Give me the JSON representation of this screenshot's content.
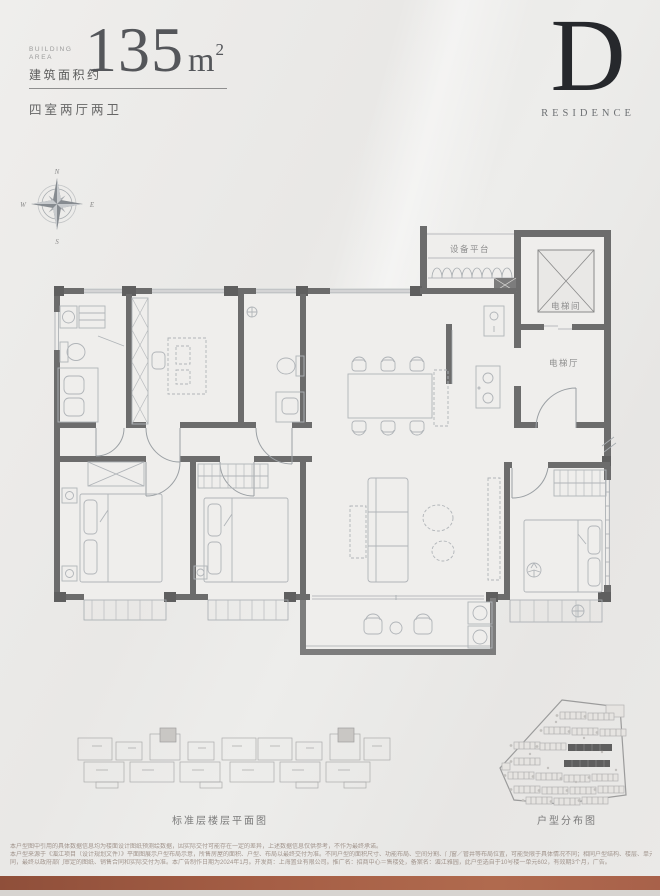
{
  "header": {
    "building_area_line1": "BUILDING",
    "building_area_line2": "AREA",
    "area_cn": "建筑面积约",
    "area_value": "135",
    "area_unit": "m",
    "area_sup": "2",
    "layout_spec": "四室两厅两卫"
  },
  "brand": {
    "letter": "D",
    "word": "RESIDENCE"
  },
  "compass": {
    "n": "N",
    "e": "E",
    "s": "S",
    "w": "W"
  },
  "plan_labels": {
    "equipment_platform": "设备平台",
    "elevator_room": "电梯间",
    "elevator_hall": "电梯厅"
  },
  "captions": {
    "standard_floor": "标准层楼层平面图",
    "distribution": "户型分布图"
  },
  "disclaimer": {
    "line1": "本户型图中引用的具体数据信息均为楼面设计图纸预测绘数据，因实际交付可能存在一定的差异，上述数据信息仅供参考，不作为最终承诺。",
    "line2": "本户型来源于《湄江项目（设计规划文件）》平面图展示户型布局示意，所售房屋的面积、户型、布局以最终交付为准。不同户型的面积尺寸、功能布局、空间分割、门窗／管井等布局位置，可能受限于具体情况不同；相同户型结构、楼层、单元等差别，局部结构、面积等也可能不",
    "line3": "同，最终以政府部门审定的图纸、销售合同和实际交付为准。本广告制作日期为2024年1月。开发商：上海置业有限公司。推广名：招商中心＝售楼处，备案名：湄江雅园，此户型选自于10号楼一单元602，有效期3个月，广告。"
  },
  "colors": {
    "accent_bar": "#a05a43",
    "wall": "#6c6c6c",
    "background": "#e9e8e6"
  }
}
